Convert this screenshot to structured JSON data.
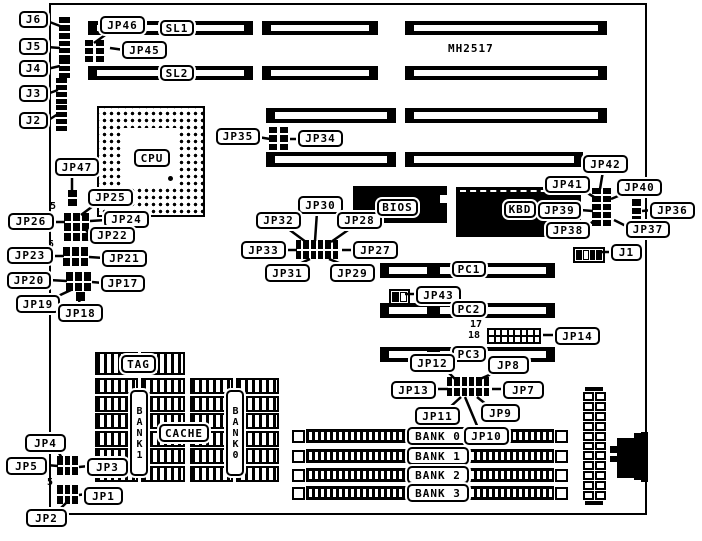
{
  "title": "MH2517",
  "chips": {
    "cpu": "CPU",
    "bios": "BIOS",
    "kbd": "KBD",
    "tag": "TAG",
    "cache": "CACHE",
    "cache_bank1": "BANK1",
    "cache_bank0": "BANK0"
  },
  "slots": {
    "sl1": "SL1",
    "sl2": "SL2",
    "pc1": "PC1",
    "pc2": "PC2",
    "pc3": "PC3"
  },
  "memory_banks": [
    "BANK 0",
    "BANK 1",
    "BANK 2",
    "BANK 3"
  ],
  "connectors": {
    "j1": "J1",
    "j2": "J2",
    "j3": "J3",
    "j4": "J4",
    "j5": "J5",
    "j6": "J6"
  },
  "jumpers": {
    "jp1": "JP1",
    "jp2": "JP2",
    "jp3": "JP3",
    "jp4": "JP4",
    "jp5": "JP5",
    "jp7": "JP7",
    "jp8": "JP8",
    "jp9": "JP9",
    "jp10": "JP10",
    "jp11": "JP11",
    "jp12": "JP12",
    "jp13": "JP13",
    "jp14": "JP14",
    "jp17": "JP17",
    "jp18": "JP18",
    "jp19": "JP19",
    "jp20": "JP20",
    "jp21": "JP21",
    "jp22": "JP22",
    "jp23": "JP23",
    "jp24": "JP24",
    "jp25": "JP25",
    "jp26": "JP26",
    "jp27": "JP27",
    "jp28": "JP28",
    "jp29": "JP29",
    "jp30": "JP30",
    "jp31": "JP31",
    "jp32": "JP32",
    "jp33": "JP33",
    "jp34": "JP34",
    "jp35": "JP35",
    "jp36": "JP36",
    "jp37": "JP37",
    "jp38": "JP38",
    "jp39": "JP39",
    "jp40": "JP40",
    "jp41": "JP41",
    "jp42": "JP42",
    "jp43": "JP43",
    "jp45": "JP45",
    "jp46": "JP46",
    "jp47": "JP47"
  },
  "pin_markers": {
    "pin5": "5",
    "pin17": "17",
    "pin18": "18"
  }
}
